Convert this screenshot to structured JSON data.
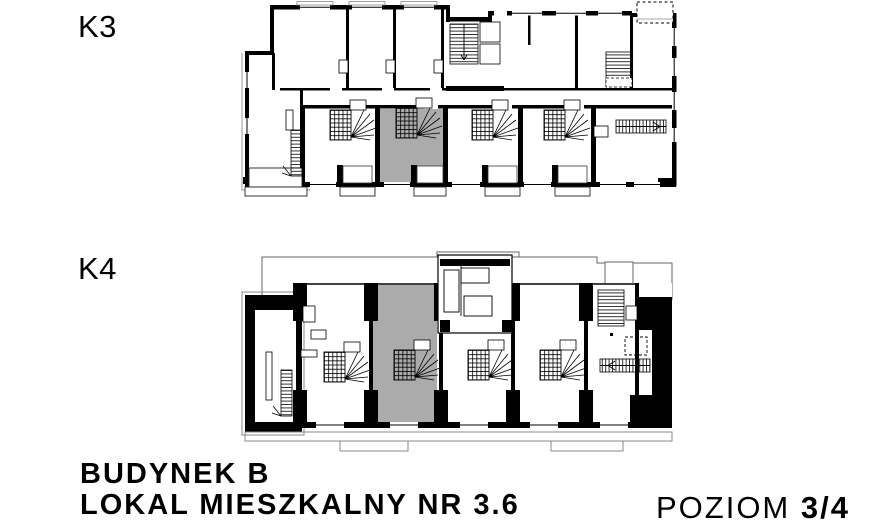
{
  "colors": {
    "highlight": "#ababab",
    "wall": "#000000",
    "background": "#ffffff"
  },
  "plan_top": {
    "label": "K3",
    "type": "floor-plan",
    "has_highlighted_unit": true
  },
  "plan_bottom": {
    "label": "K4",
    "type": "floor-plan",
    "has_highlighted_unit": true
  },
  "footer": {
    "building": "BUDYNEK B",
    "unit": "LOKAL MIESZKALNY NR 3.6",
    "level_label": "POZIOM",
    "level_value": "3/4"
  }
}
